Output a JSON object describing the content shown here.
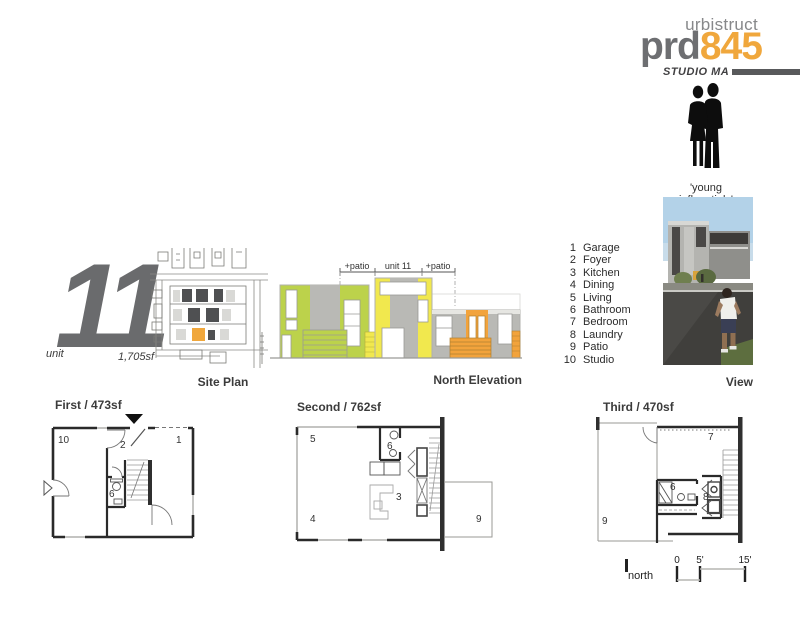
{
  "branding": {
    "name": "urbistruct",
    "logo_prefix": "prd",
    "logo_number": "845",
    "studio": "STUDIO MA",
    "accent_color": "#f0a73c",
    "gray_color": "#6d6e71"
  },
  "persona": {
    "label": "'young influentials'"
  },
  "view": {
    "label": "View"
  },
  "unit": {
    "label": "unit",
    "number": "11",
    "area": "1,705sf"
  },
  "site_plan": {
    "label": "Site Plan",
    "highlight_color": "#f0a73c"
  },
  "elevation": {
    "label": "North Elevation",
    "dims": {
      "left": "+patio",
      "center": "unit 11",
      "right": "+patio"
    },
    "colors": {
      "green": "#bcd24b",
      "yellow": "#f1e84e",
      "orange": "#f2a33c",
      "gray": "#b9b9b5"
    }
  },
  "legend": {
    "items": [
      {
        "num": "1",
        "name": "Garage"
      },
      {
        "num": "2",
        "name": "Foyer"
      },
      {
        "num": "3",
        "name": "Kitchen"
      },
      {
        "num": "4",
        "name": "Dining"
      },
      {
        "num": "5",
        "name": "Living"
      },
      {
        "num": "6",
        "name": "Bathroom"
      },
      {
        "num": "7",
        "name": "Bedroom"
      },
      {
        "num": "8",
        "name": "Laundry"
      },
      {
        "num": "9",
        "name": "Patio"
      },
      {
        "num": "10",
        "name": "Studio"
      }
    ]
  },
  "plans": {
    "first": {
      "title": "First / 473sf",
      "rooms": {
        "studio": "10",
        "foyer": "2",
        "garage": "1",
        "bath": "6"
      }
    },
    "second": {
      "title": "Second / 762sf",
      "rooms": {
        "living": "5",
        "bath": "6",
        "kitchen": "3",
        "dining": "4",
        "patio": "9"
      }
    },
    "third": {
      "title": "Third / 470sf",
      "rooms": {
        "bedroom": "7",
        "bath": "6",
        "laundry": "8",
        "patio": "9"
      }
    }
  },
  "scalebar": {
    "north": "north",
    "ticks": {
      "zero": "0",
      "five": "5'",
      "fifteen": "15'"
    }
  }
}
